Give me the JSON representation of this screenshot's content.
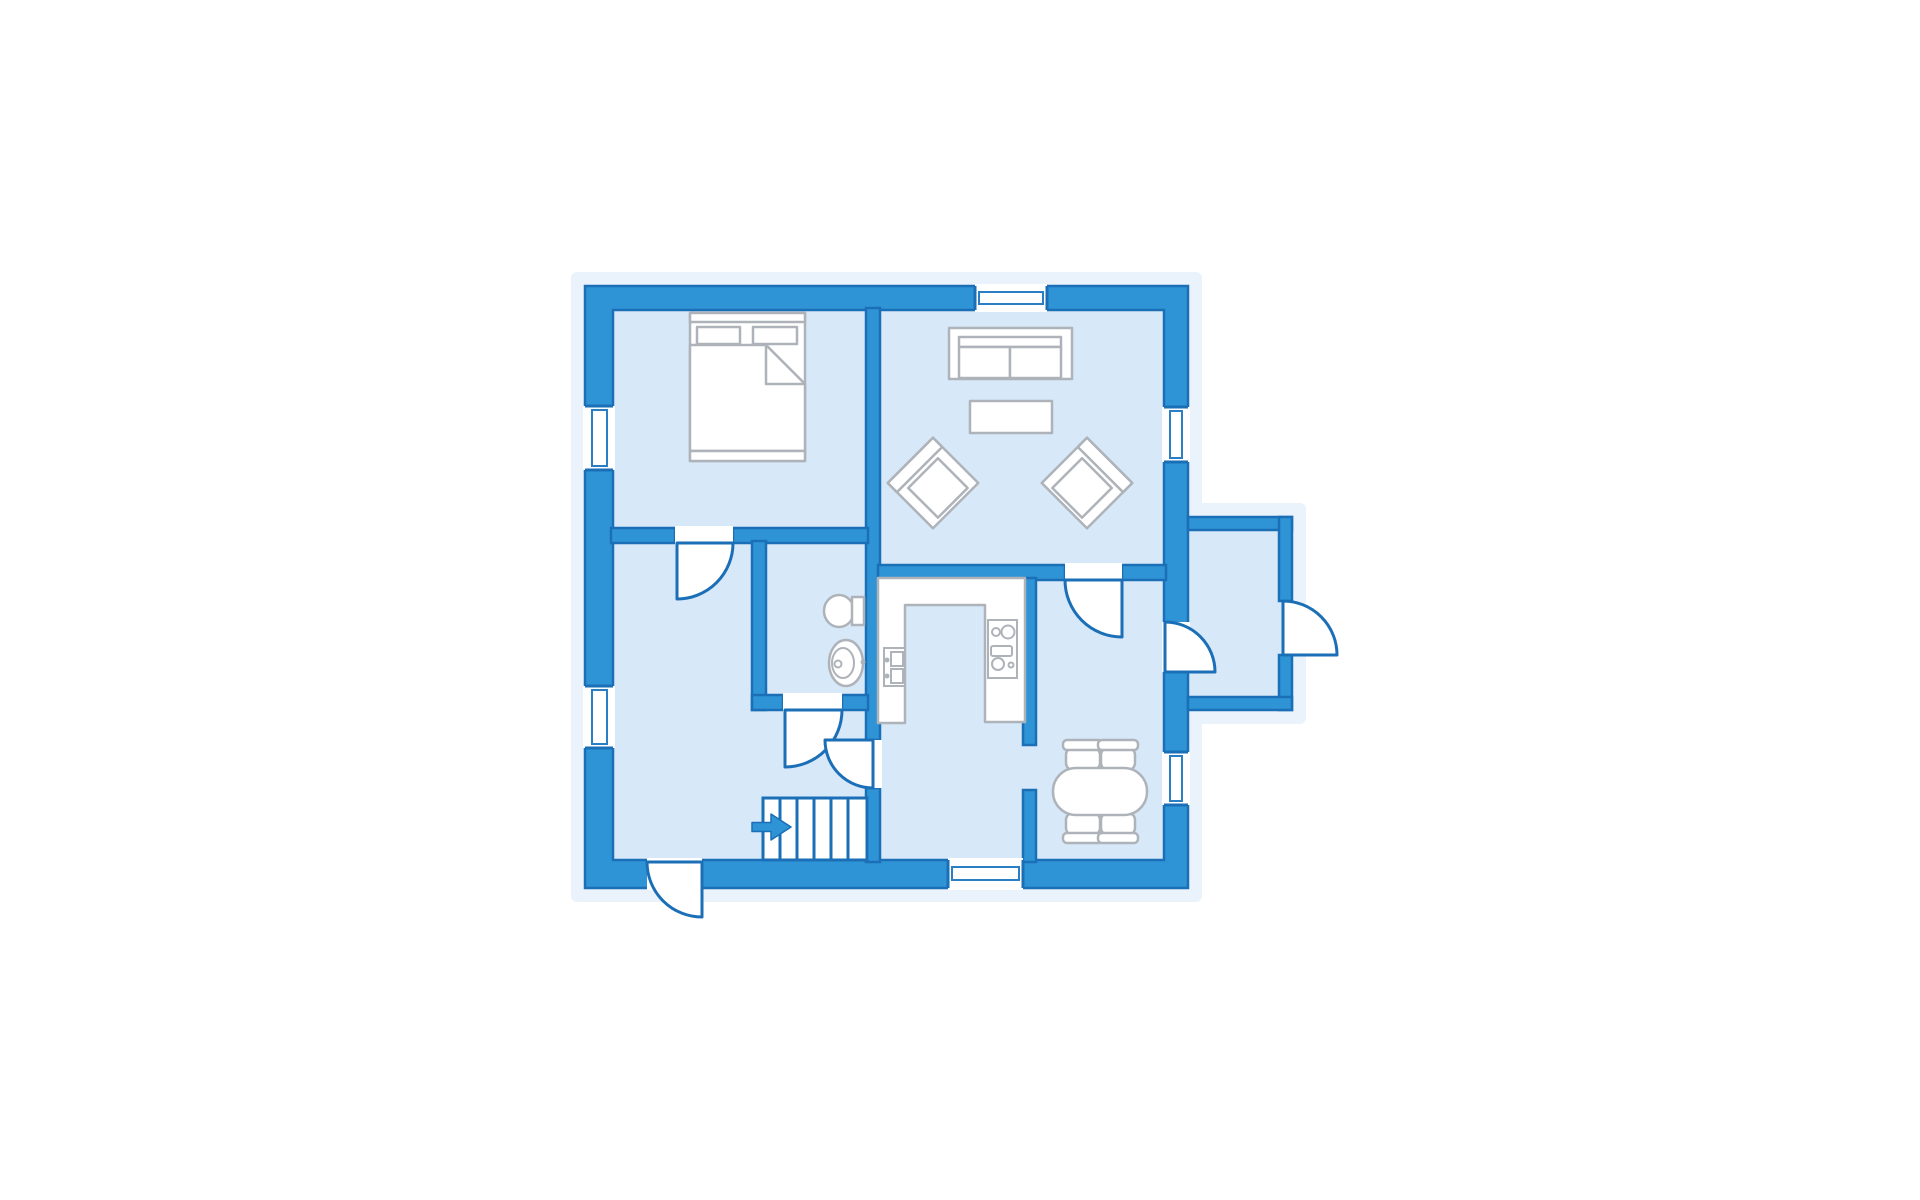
{
  "diagram": {
    "type": "floor-plan",
    "title": "single-storey house floor plan (no text labels rendered)",
    "colors": {
      "wall": "#2e94d6",
      "outline": "#1b6fb6",
      "frame": "#2a7fc4",
      "room": "#d7e8f9",
      "halo": "#eaf3fb",
      "furn": "#aeb3b9",
      "background": "#ffffff"
    },
    "rooms": [
      {
        "id": "bedroom",
        "position": "top-left",
        "furniture": [
          "double-bed",
          "two-pillows",
          "folded-blanket"
        ]
      },
      {
        "id": "living-room",
        "position": "top-right",
        "furniture": [
          "sofa",
          "coffee-table",
          "armchair-left",
          "armchair-right"
        ]
      },
      {
        "id": "lounge-hall",
        "position": "bottom-left",
        "furniture": [
          "staircase",
          "entry-arrow"
        ]
      },
      {
        "id": "bathroom",
        "position": "center",
        "furniture": [
          "toilet",
          "pedestal-sink"
        ]
      },
      {
        "id": "kitchen",
        "position": "center-right",
        "furniture": [
          "u-shaped-counter",
          "double-sink",
          "stove-4-burners"
        ]
      },
      {
        "id": "dining-room",
        "position": "bottom-right",
        "furniture": [
          "oval-table",
          "chair",
          "chair",
          "chair",
          "chair"
        ]
      },
      {
        "id": "porch-annex",
        "position": "right",
        "furniture": []
      }
    ],
    "windows": [
      {
        "wall": "left",
        "room": "bedroom"
      },
      {
        "wall": "left",
        "room": "lounge-hall"
      },
      {
        "wall": "top",
        "room": "living-room"
      },
      {
        "wall": "right",
        "room": "living-room"
      },
      {
        "wall": "right",
        "room": "dining-room"
      },
      {
        "wall": "bottom",
        "room": "kitchen"
      }
    ],
    "doors": [
      {
        "from": "bedroom",
        "to": "lounge-hall"
      },
      {
        "from": "bathroom",
        "to": "kitchen-hall"
      },
      {
        "from": "living-room",
        "to": "dining-room"
      },
      {
        "from": "lounge-hall",
        "to": "kitchen-hall"
      },
      {
        "from": "dining-room",
        "to": "porch-annex"
      },
      {
        "from": "porch-annex",
        "to": "outside"
      },
      {
        "from": "lounge-hall",
        "to": "outside-front"
      }
    ],
    "stairs": {
      "treads": 6,
      "entry_arrow_direction": "right"
    }
  }
}
